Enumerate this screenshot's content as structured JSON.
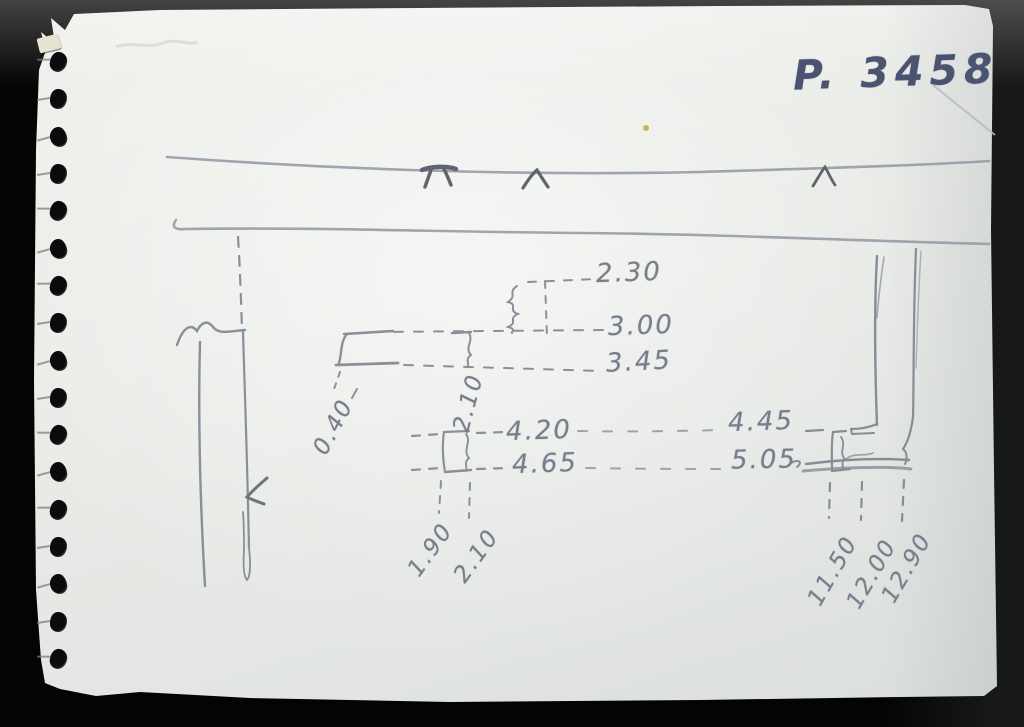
{
  "photo": {
    "description": "pencil sketch of a stratigraphic profile on a torn spiral-notebook page",
    "page_number": "P. 3458",
    "colors": {
      "background": "#040404",
      "paper": "#e9ebe6",
      "pencil": "#8b8f9a",
      "ink": "#4a5470"
    },
    "measurements": {
      "center_levels": [
        "2.30",
        "3.00",
        "3.45",
        "4.20",
        "4.65"
      ],
      "right_levels": [
        "4.45",
        "5.05"
      ],
      "width_small": "0.40",
      "height_center": "2.10",
      "bottom_left_depths": [
        "1.90",
        "2.10"
      ],
      "bottom_right_depths": [
        "11.50",
        "12.00",
        "12.90"
      ]
    }
  }
}
